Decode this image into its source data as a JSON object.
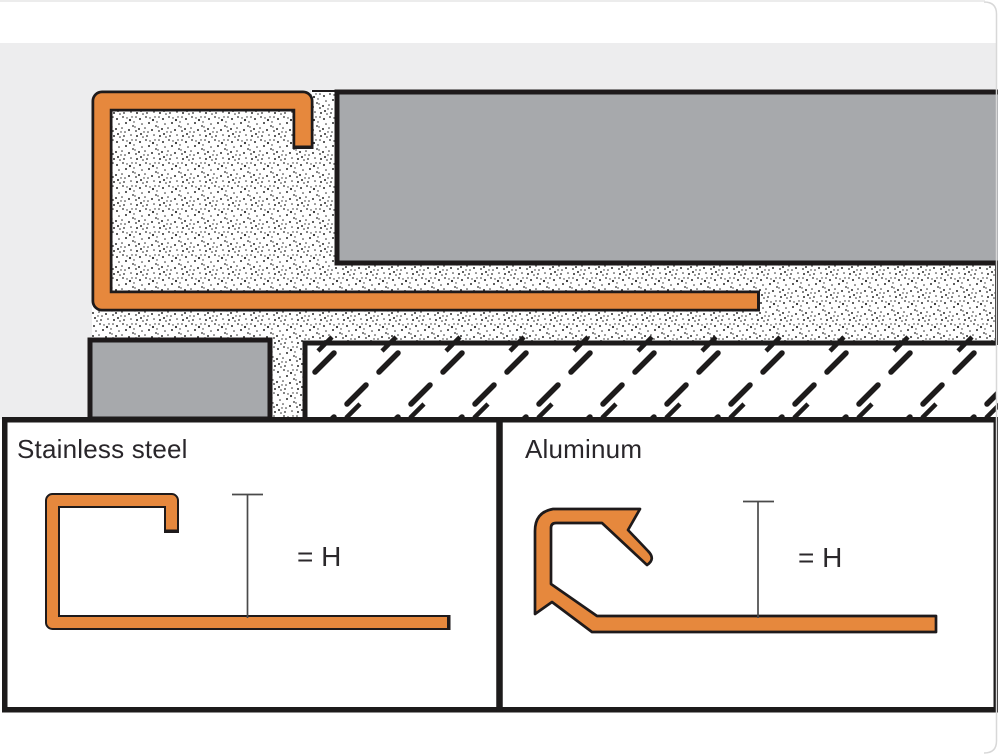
{
  "colors": {
    "accent_orange": "#E6883D",
    "outline_black": "#1E1A1B",
    "tile_gray": "#A7A9AC",
    "background_gray": "#EDEDEE",
    "dimension_gray": "#4A4A4A"
  },
  "panels": [
    {
      "label": "Stainless steel",
      "dimension_label": "= H"
    },
    {
      "label": "Aluminum",
      "dimension_label": "= H"
    }
  ]
}
